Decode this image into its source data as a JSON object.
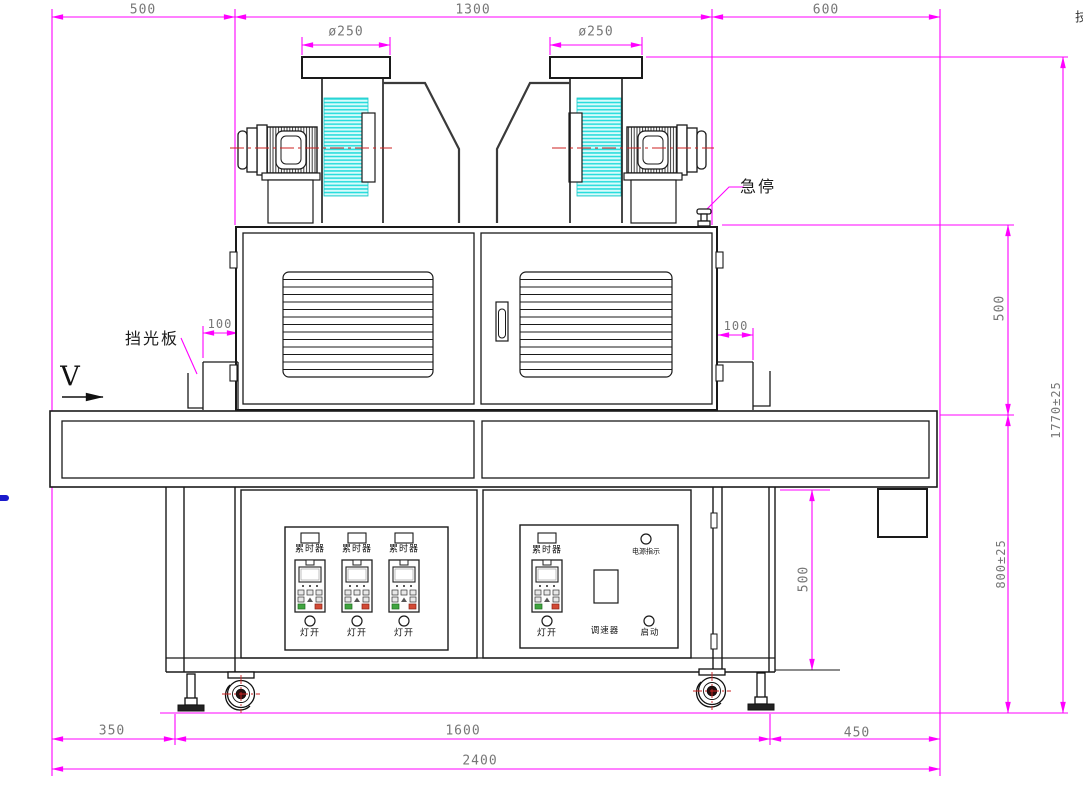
{
  "drawing": {
    "type": "engineering-front-view",
    "subject": "UV curing conveyor machine with twin exhaust blowers"
  },
  "colors": {
    "dimension_line": "#ff00ff",
    "outline": "#1a1a1a",
    "centerline_red": "#cc2222",
    "hatch_cyan": "#25dcdc",
    "dim_text": "#777777",
    "indicator_green": "#3fa43f",
    "indicator_red": "#d24a35"
  },
  "dimensions": {
    "top_left": "500",
    "top_center": "1300",
    "top_right": "600",
    "duct_left": "ø250",
    "duct_right": "ø250",
    "shelf_left": "100",
    "shelf_right": "100",
    "oven_height": "500",
    "frame_height": "500",
    "belt_height": "800±25",
    "overall_height": "1770±25",
    "bottom_left": "350",
    "bottom_center": "1600",
    "bottom_right": "450",
    "overall_width": "2400"
  },
  "labels": {
    "emergency_stop": "急停",
    "light_shield": "挡光板",
    "direction": "V",
    "hour_meter": "累时器",
    "lamp_switch": "灯开",
    "power_indicator": "电源指示",
    "speed_controller": "调速器",
    "start_button": "启动",
    "edge_clipped_text": "技"
  }
}
